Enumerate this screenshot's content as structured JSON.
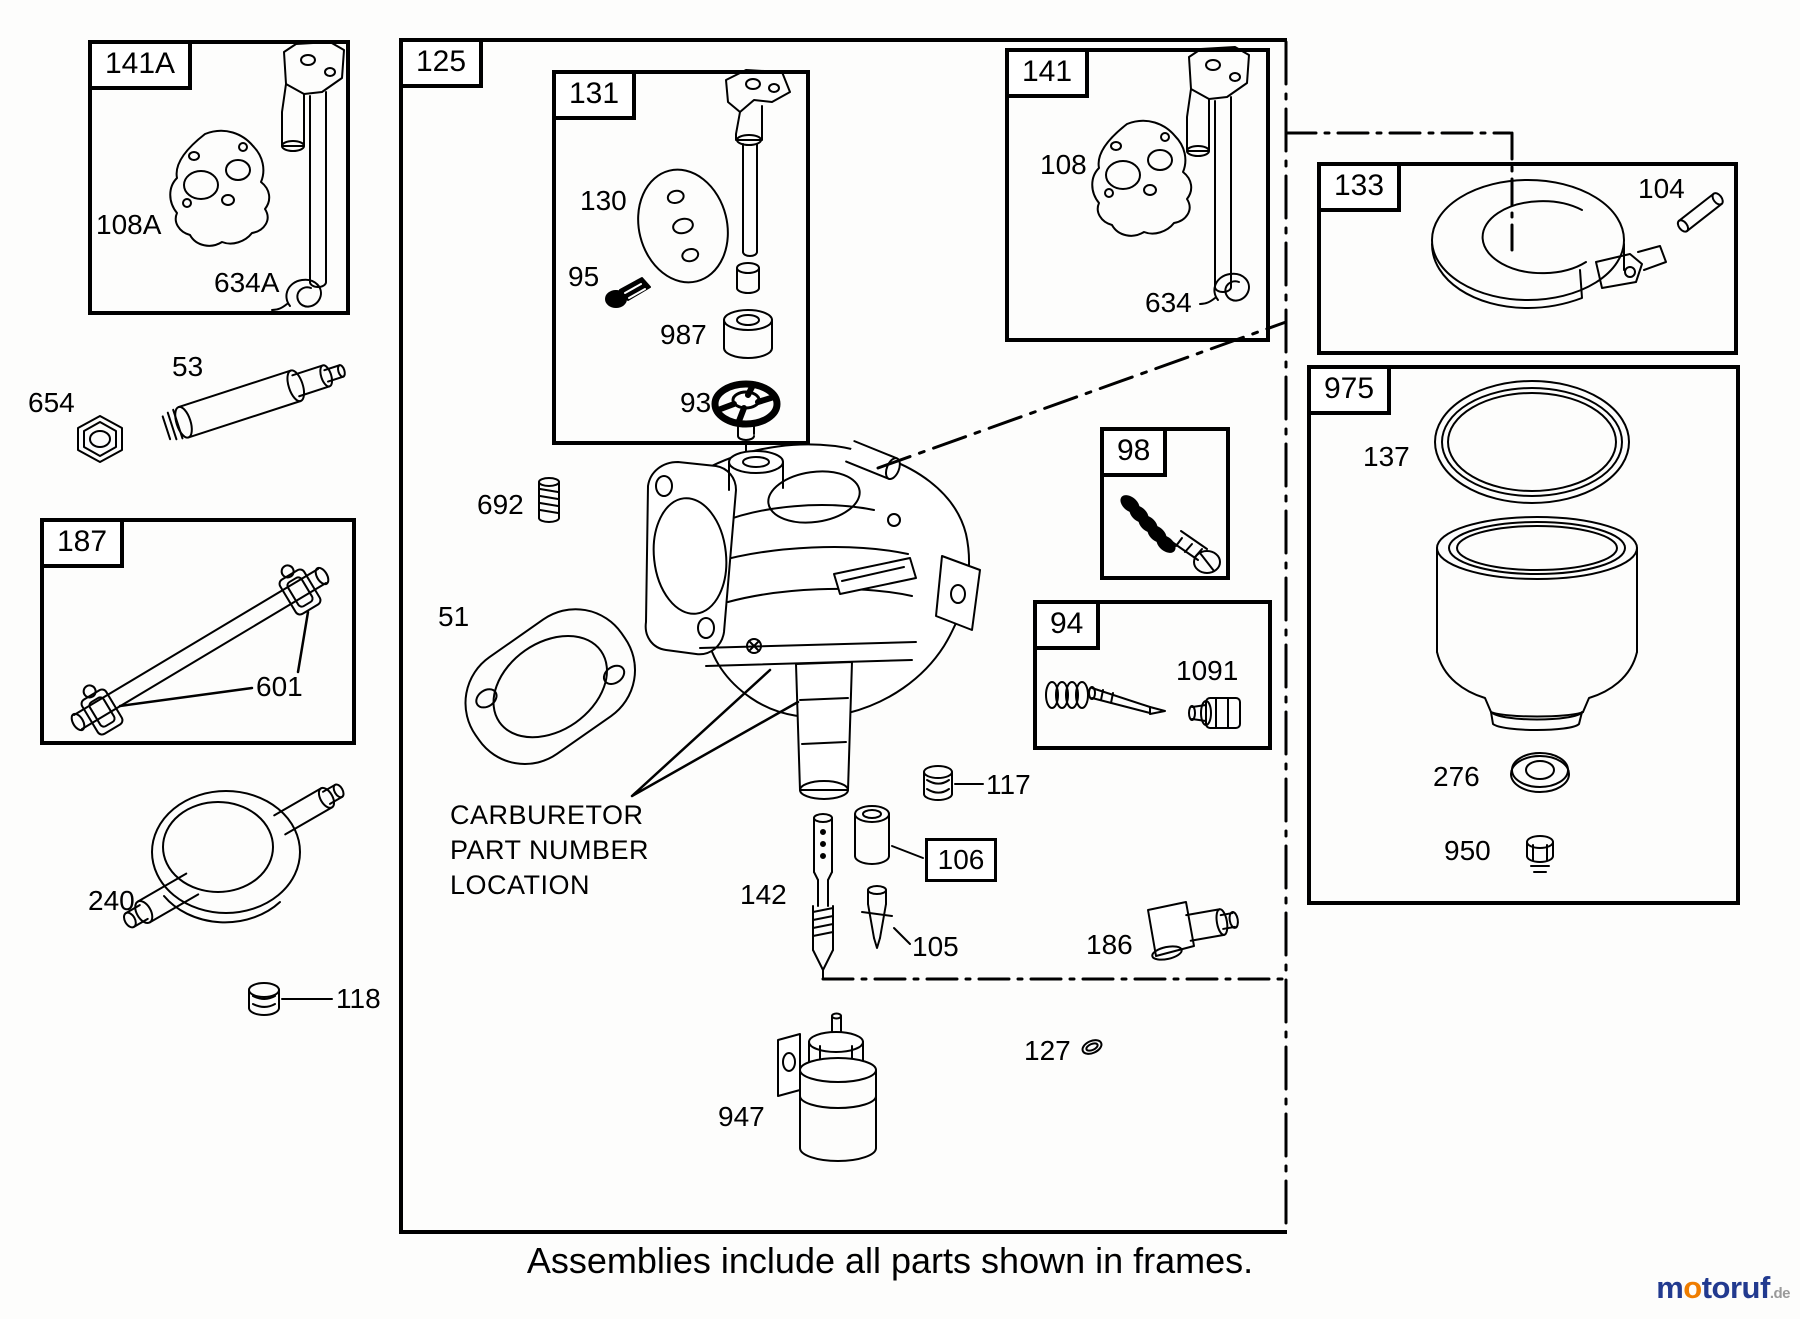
{
  "colors": {
    "line": "#000000",
    "background": "#fdfdfc",
    "logo_blue": "#223a8f",
    "logo_orange": "#ef7d00",
    "logo_gray": "#9a9a9a"
  },
  "caption": {
    "text": "Assemblies include all parts shown in frames."
  },
  "note": {
    "lines": [
      "CARBURETOR",
      "PART NUMBER",
      "LOCATION"
    ]
  },
  "logo": {
    "part1": "m",
    "part2": "o",
    "part3": "toruf",
    "tld": ".de"
  },
  "frames": [
    {
      "id": "141A",
      "label": "141A",
      "x": 88,
      "y": 40,
      "w": 262,
      "h": 275
    },
    {
      "id": "187",
      "label": "187",
      "x": 40,
      "y": 518,
      "w": 316,
      "h": 227
    },
    {
      "id": "125",
      "label": "125",
      "x": 399,
      "y": 38,
      "w": 888,
      "h": 1196,
      "dashed_right": true
    },
    {
      "id": "131",
      "label": "131",
      "x": 552,
      "y": 70,
      "w": 258,
      "h": 375
    },
    {
      "id": "141",
      "label": "141",
      "x": 1005,
      "y": 48,
      "w": 265,
      "h": 294
    },
    {
      "id": "98",
      "label": "98",
      "x": 1100,
      "y": 427,
      "w": 130,
      "h": 153
    },
    {
      "id": "94",
      "label": "94",
      "x": 1033,
      "y": 600,
      "w": 239,
      "h": 150
    },
    {
      "id": "133",
      "label": "133",
      "x": 1317,
      "y": 162,
      "w": 421,
      "h": 193
    },
    {
      "id": "975",
      "label": "975",
      "x": 1307,
      "y": 365,
      "w": 433,
      "h": 540
    }
  ],
  "labels": [
    {
      "id": "108A",
      "text": "108A",
      "x": 96,
      "y": 210
    },
    {
      "id": "634A",
      "text": "634A",
      "x": 214,
      "y": 268
    },
    {
      "id": "654",
      "text": "654",
      "x": 28,
      "y": 388
    },
    {
      "id": "53",
      "text": "53",
      "x": 172,
      "y": 352
    },
    {
      "id": "601",
      "text": "601",
      "x": 256,
      "y": 672
    },
    {
      "id": "240",
      "text": "240",
      "x": 88,
      "y": 886
    },
    {
      "id": "118",
      "text": "118",
      "x": 336,
      "y": 984
    },
    {
      "id": "130",
      "text": "130",
      "x": 580,
      "y": 186
    },
    {
      "id": "95",
      "text": "95",
      "x": 568,
      "y": 262
    },
    {
      "id": "987",
      "text": "987",
      "x": 660,
      "y": 320
    },
    {
      "id": "93",
      "text": "93",
      "x": 680,
      "y": 388
    },
    {
      "id": "692",
      "text": "692",
      "x": 477,
      "y": 490
    },
    {
      "id": "51",
      "text": "51",
      "x": 438,
      "y": 602
    },
    {
      "id": "108",
      "text": "108",
      "x": 1040,
      "y": 150
    },
    {
      "id": "634",
      "text": "634",
      "x": 1145,
      "y": 288
    },
    {
      "id": "1091",
      "text": "1091",
      "x": 1176,
      "y": 656
    },
    {
      "id": "117",
      "text": "117",
      "x": 986,
      "y": 770
    },
    {
      "id": "142",
      "text": "142",
      "x": 740,
      "y": 880
    },
    {
      "id": "105",
      "text": "105",
      "x": 912,
      "y": 932
    },
    {
      "id": "186",
      "text": "186",
      "x": 1086,
      "y": 930
    },
    {
      "id": "127",
      "text": "127",
      "x": 1024,
      "y": 1036
    },
    {
      "id": "947",
      "text": "947",
      "x": 718,
      "y": 1102
    },
    {
      "id": "104",
      "text": "104",
      "x": 1638,
      "y": 174
    },
    {
      "id": "137",
      "text": "137",
      "x": 1363,
      "y": 442
    },
    {
      "id": "276",
      "text": "276",
      "x": 1433,
      "y": 762
    },
    {
      "id": "950",
      "text": "950",
      "x": 1444,
      "y": 836
    }
  ],
  "boxed_labels": [
    {
      "id": "106",
      "text": "106",
      "x": 925,
      "y": 838,
      "w": 72,
      "h": 44
    }
  ]
}
